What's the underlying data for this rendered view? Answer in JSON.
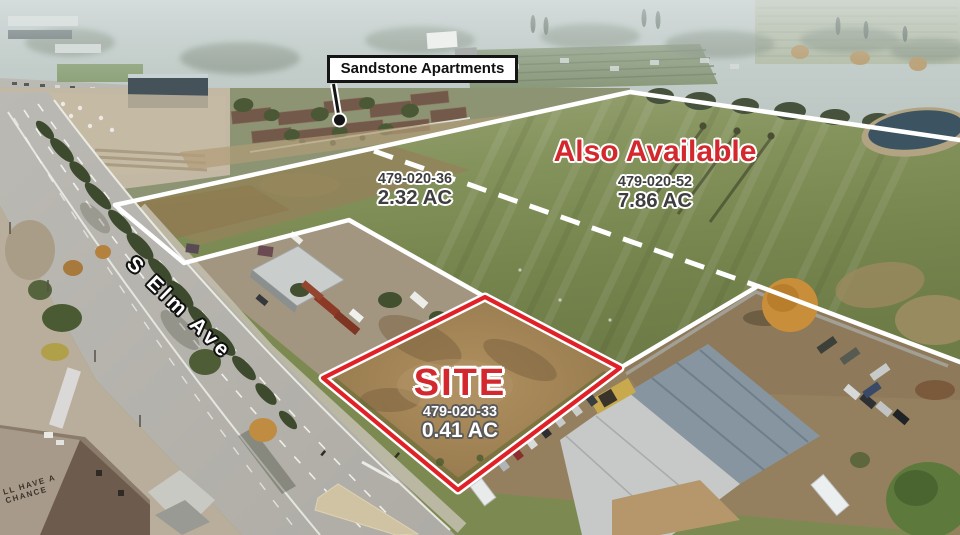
{
  "annotations": {
    "callout": {
      "label": "Sandstone Apartments"
    },
    "availability": {
      "label": "Also Available"
    },
    "parcels": {
      "p36": {
        "apn": "479-020-36",
        "acres": "2.32 AC"
      },
      "p52": {
        "apn": "479-020-52",
        "acres": "7.86 AC"
      },
      "site": {
        "label": "SITE",
        "apn": "479-020-33",
        "acres": "0.41 AC"
      }
    },
    "street": {
      "label": "S Elm Ave"
    }
  },
  "photo_text": {
    "building_sign": {
      "line1": "LL HAVE A",
      "line2": "CHANCE"
    }
  },
  "colors": {
    "accent_red": "#d2282e",
    "boundary_red": "#e02228",
    "boundary_white": "#ffffff",
    "label_gray": "#3e3e3e",
    "label_white": "#ffffff",
    "callout_bg": "#ffffff",
    "callout_border": "#151515"
  }
}
